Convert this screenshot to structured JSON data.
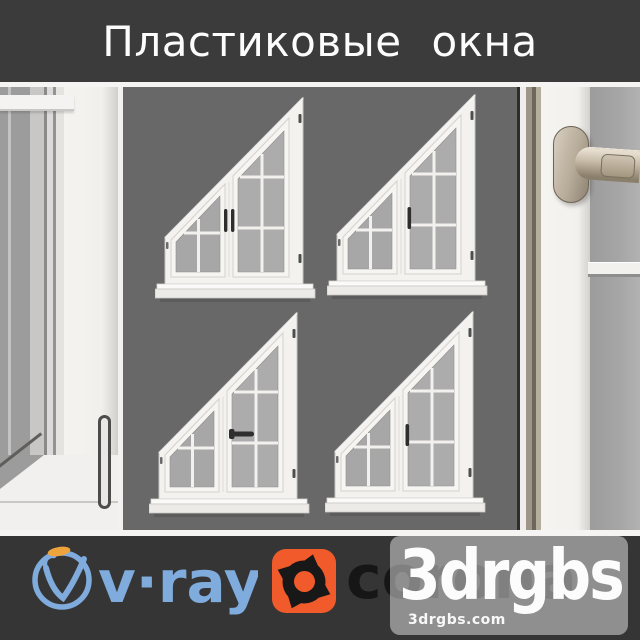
{
  "title_bar": {
    "title": "Пластиковые окна",
    "bg_color": "#3b3b3b",
    "text_color": "#fcfcfc"
  },
  "scene": {
    "wall_color": "#686868",
    "frame_color": "#f3f2ef",
    "glass_color": "#a9a9a9",
    "windows": [
      {
        "id": "top-left",
        "handle": "double-vertical"
      },
      {
        "id": "top-right",
        "handle": "single-vertical"
      },
      {
        "id": "bottom-left",
        "handle": "single-horizontal"
      },
      {
        "id": "bottom-right",
        "handle": "single-vertical"
      }
    ]
  },
  "footer": {
    "bg_color": "#353535",
    "vray": {
      "label": "v·ray",
      "blue": "#7fabdd",
      "orange": "#eda43c"
    },
    "corona": {
      "label": "corona",
      "icon_color": "#f15b2b",
      "text_color": "#161616"
    },
    "watermark": {
      "brand": "3drgbs",
      "url": "3drgbs.com",
      "text_color": "#fcfcfc"
    }
  }
}
